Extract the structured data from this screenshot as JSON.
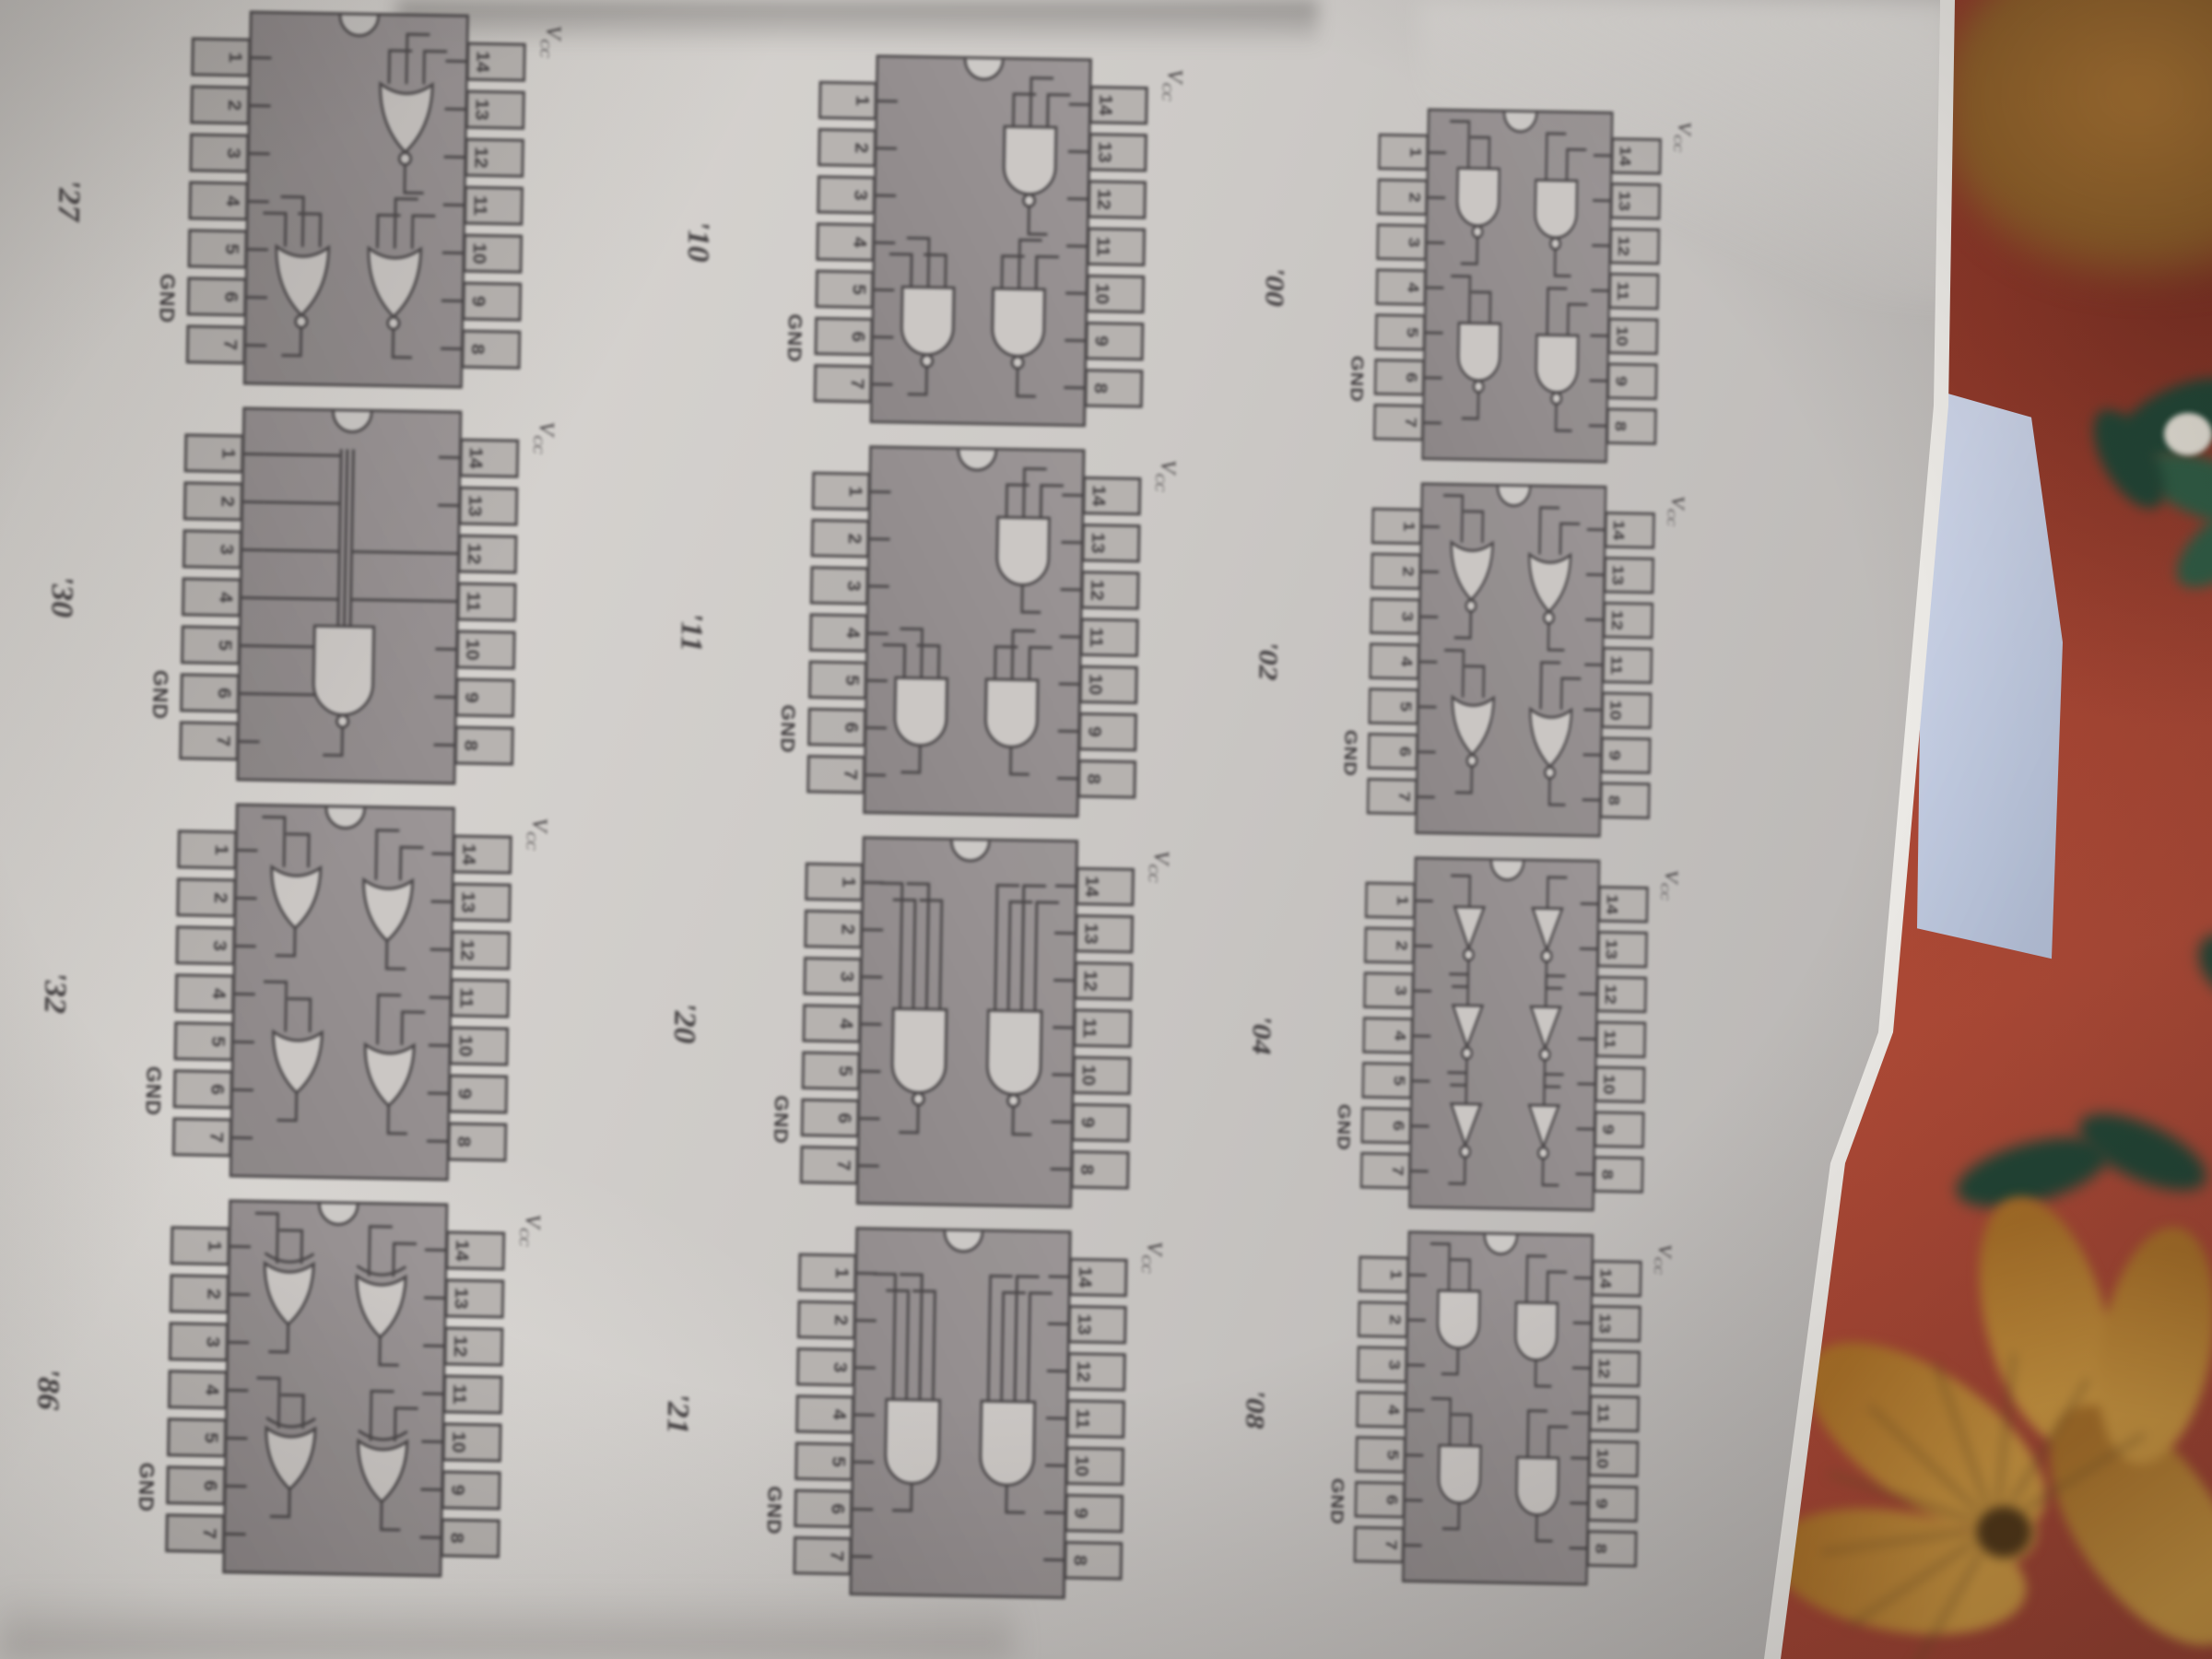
{
  "figure": {
    "vcc_main": "V",
    "vcc_sub": "CC",
    "gnd": "GND",
    "pins_top": [
      "14",
      "13",
      "12",
      "11",
      "10",
      "9",
      "8"
    ],
    "pins_bottom": [
      "1",
      "2",
      "3",
      "4",
      "5",
      "6",
      "7"
    ],
    "rows": [
      {
        "chips": [
          {
            "label": "'00",
            "gate": "nand",
            "count": 4,
            "inputs": 2
          },
          {
            "label": "'02",
            "gate": "nor",
            "count": 4,
            "inputs": 2
          },
          {
            "label": "'04",
            "gate": "inv",
            "count": 6,
            "inputs": 1
          },
          {
            "label": "'08",
            "gate": "and",
            "count": 4,
            "inputs": 2
          }
        ]
      },
      {
        "chips": [
          {
            "label": "'10",
            "gate": "nand",
            "count": 3,
            "inputs": 3
          },
          {
            "label": "'11",
            "gate": "and",
            "count": 3,
            "inputs": 3
          },
          {
            "label": "'20",
            "gate": "nand",
            "count": 2,
            "inputs": 4
          },
          {
            "label": "'21",
            "gate": "and",
            "count": 2,
            "inputs": 4
          }
        ]
      },
      {
        "chips": [
          {
            "label": "'27",
            "gate": "nor",
            "count": 3,
            "inputs": 3
          },
          {
            "label": "'30",
            "gate": "nand",
            "count": 1,
            "inputs": 8
          },
          {
            "label": "'32",
            "gate": "or",
            "count": 4,
            "inputs": 2
          },
          {
            "label": "'86",
            "gate": "xor",
            "count": 4,
            "inputs": 2
          }
        ]
      }
    ]
  },
  "colors": {
    "cloth_red": "#9c3e2e",
    "cloth_red_dark": "#7c2e21",
    "cloth_red_bright": "#b04a36",
    "flower_blur_brown": "#a87230",
    "flower_petal": "#d0993f",
    "flower_petal_deep": "#aa7026",
    "flower_streak": "#6e4c20",
    "flower_center": "#4e3414",
    "leaf_green": "#2e5c44",
    "leaf_green_dark": "#1f4434",
    "white_flower": "#e6e2d8",
    "blue_sheet_light": "#ccd4e8",
    "blue_sheet": "#b6c2da",
    "page_light": "#dcd9d5",
    "page_mid": "#ccc9c6",
    "page_dark": "#b4b1af",
    "page_edge": "#eeece8",
    "chip_body": "#9a9495",
    "chip_body_dark": "#8a8485",
    "chip_line": "#454143",
    "pin_fill": "#b6b2af",
    "gate_fill": "#cbc7c4",
    "ink": "#3e3a3c"
  }
}
